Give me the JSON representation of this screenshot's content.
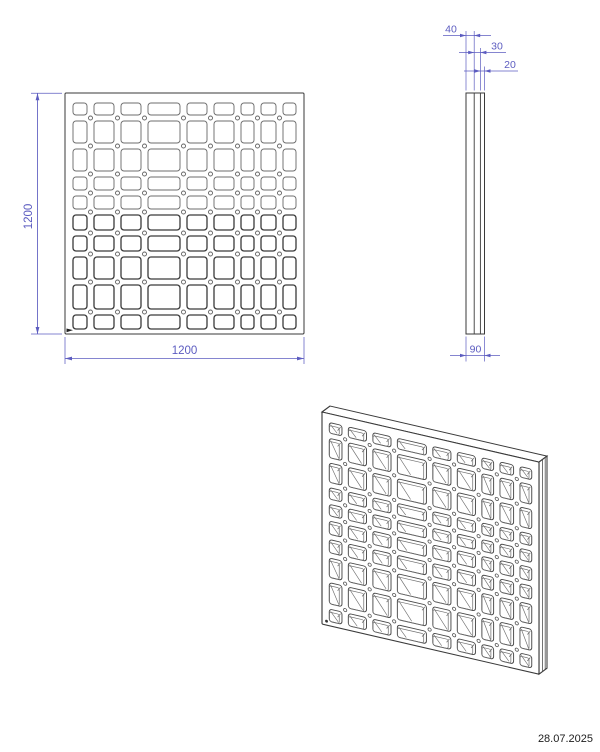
{
  "date_label": "28.07.2025",
  "front_view": {
    "height_dim": "1200",
    "width_dim": "1200"
  },
  "side_view": {
    "dim_layer_outer": "40",
    "dim_layer_middle": "30",
    "dim_layer_inner": "20",
    "dim_total_thickness": "90"
  },
  "colors": {
    "line": "#3a3a3a",
    "line_light": "#6e6e6e",
    "dimension": "#5c5cc0",
    "background": "#ffffff"
  },
  "pattern": {
    "columns": [
      14,
      20,
      20,
      32,
      20,
      20,
      13,
      15,
      13
    ],
    "rows": [
      12,
      22,
      22,
      13,
      13,
      15,
      15,
      22,
      24,
      14
    ],
    "col_gap": 7,
    "row_gap": 6,
    "pad_left": 8,
    "pad_top": 10,
    "panel_w": 239,
    "panel_h": 241,
    "hole_radius": 3,
    "circle_r": 2
  }
}
